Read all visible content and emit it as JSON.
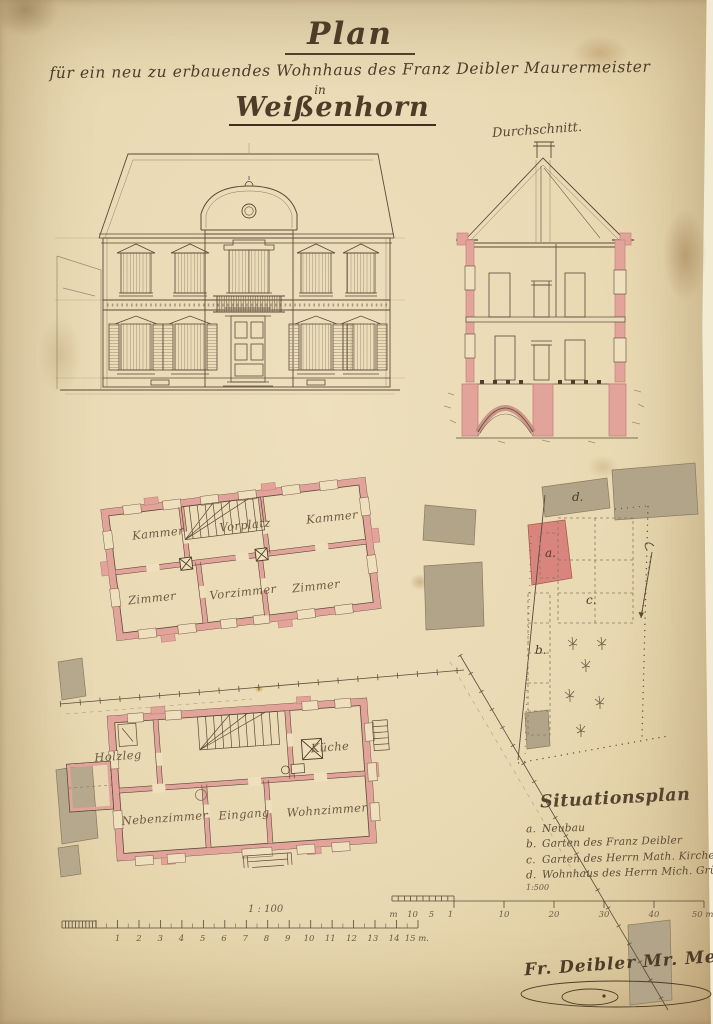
{
  "page": {
    "title_word": "Plan",
    "subtitle": "für ein neu zu erbauendes Wohnhaus des Franz Deibler Maurermeister",
    "in_word": "in",
    "town": "Weißenhorn"
  },
  "drawings": {
    "section_label": "Durchschnitt.",
    "upper_floor": {
      "kammer_left": "Kammer",
      "vorplatz": "Vorplatz",
      "kammer_right": "Kammer",
      "zimmer_left": "Zimmer",
      "vorzimmer": "Vorzimmer",
      "zimmer_right": "Zimmer"
    },
    "ground_floor": {
      "nebenzimmer": "Nebenzimmer",
      "eingang": "Eingang",
      "wohnzimmer": "Wohnzimmer",
      "kueche": "Küche",
      "holzleg": "Holzleg"
    },
    "site": {
      "a": "a.",
      "b": "b.",
      "c": "c.",
      "d": "d."
    }
  },
  "legend": {
    "heading": "Situationsplan",
    "items": [
      {
        "k": "a.",
        "t": "Neubau"
      },
      {
        "k": "b.",
        "t": "Garten des Franz Deibler"
      },
      {
        "k": "c.",
        "t": "Garten des Herrn Math. Kircher."
      },
      {
        "k": "d.",
        "t": "Wohnhaus des Herrn Mich. Grünwied."
      }
    ],
    "scale_note": "1:500"
  },
  "scalebars": {
    "plan_scale_label": "1 : 100",
    "plan_ticks": [
      "1",
      "2",
      "3",
      "4",
      "5",
      "6",
      "7",
      "8",
      "9",
      "10",
      "11",
      "12",
      "13",
      "14",
      "15 m."
    ],
    "site_minor": [
      "m",
      "10",
      "5",
      "1"
    ],
    "site_major": [
      "10",
      "20",
      "30",
      "40",
      "50 m."
    ]
  },
  "signature": "Fr. Deibler Mr. Meister",
  "colors": {
    "ink": "#4e3c28",
    "wall_pink": "#e2a39a",
    "wash_gray": "#b5a88d",
    "neubau_red": "#d9857e",
    "paper": "#e9d9b3"
  }
}
